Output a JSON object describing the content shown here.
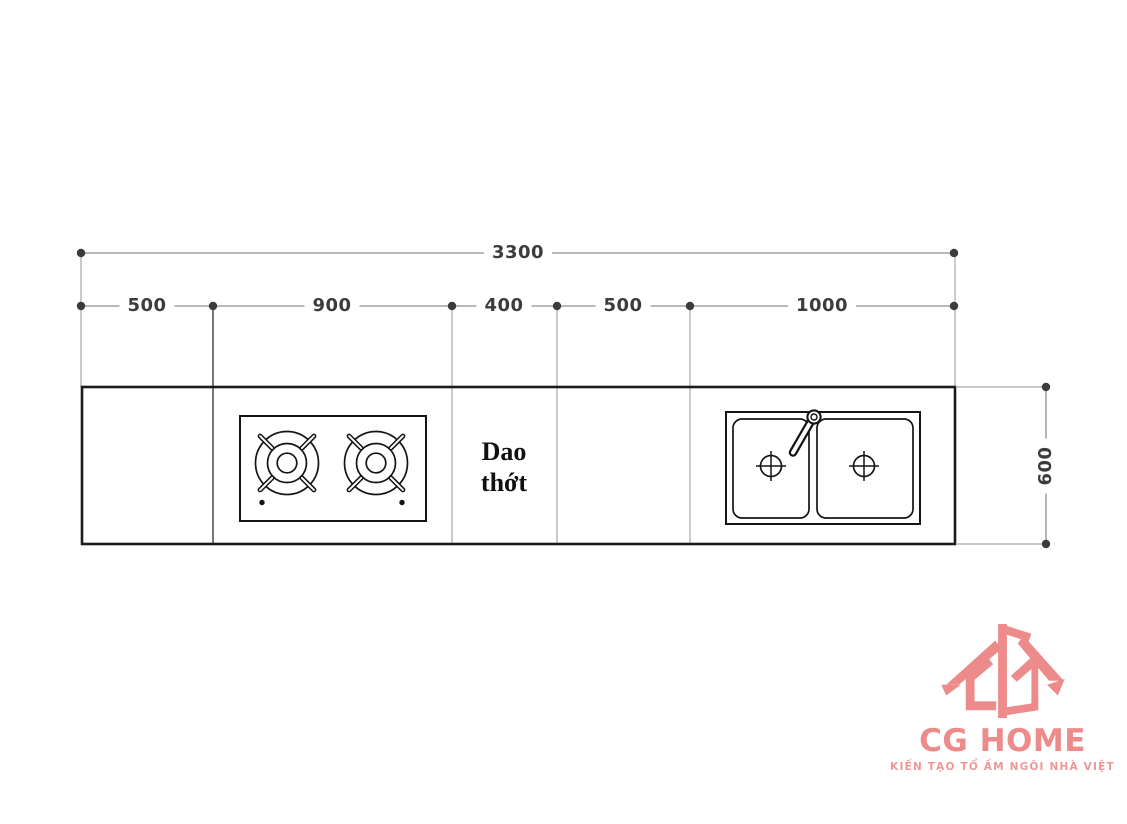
{
  "page": {
    "background": "#ffffff"
  },
  "dimensions": {
    "total": "3300",
    "segments": [
      "500",
      "900",
      "400",
      "500",
      "1000"
    ],
    "depth": "600"
  },
  "countertop": {
    "cutting_board_line1": "Dao",
    "cutting_board_line2": "thớt",
    "fixtures": [
      "two-burner-gas-hob",
      "double-bowl-sink-with-faucet"
    ]
  },
  "logo": {
    "name": "CG HOME",
    "tagline": "KIẾN TẠO TỔ ẤM NGÔI NHÀ VIỆT",
    "color": "#ed8b8b"
  },
  "colors": {
    "dimension_line": "#8f8f8f",
    "dimension_dot": "#3b3b3b",
    "dimension_text": "#3c3c3c",
    "extension_line": "#a8a8a8",
    "outline": "#1b1b1b",
    "fixture_line": "#141414"
  }
}
